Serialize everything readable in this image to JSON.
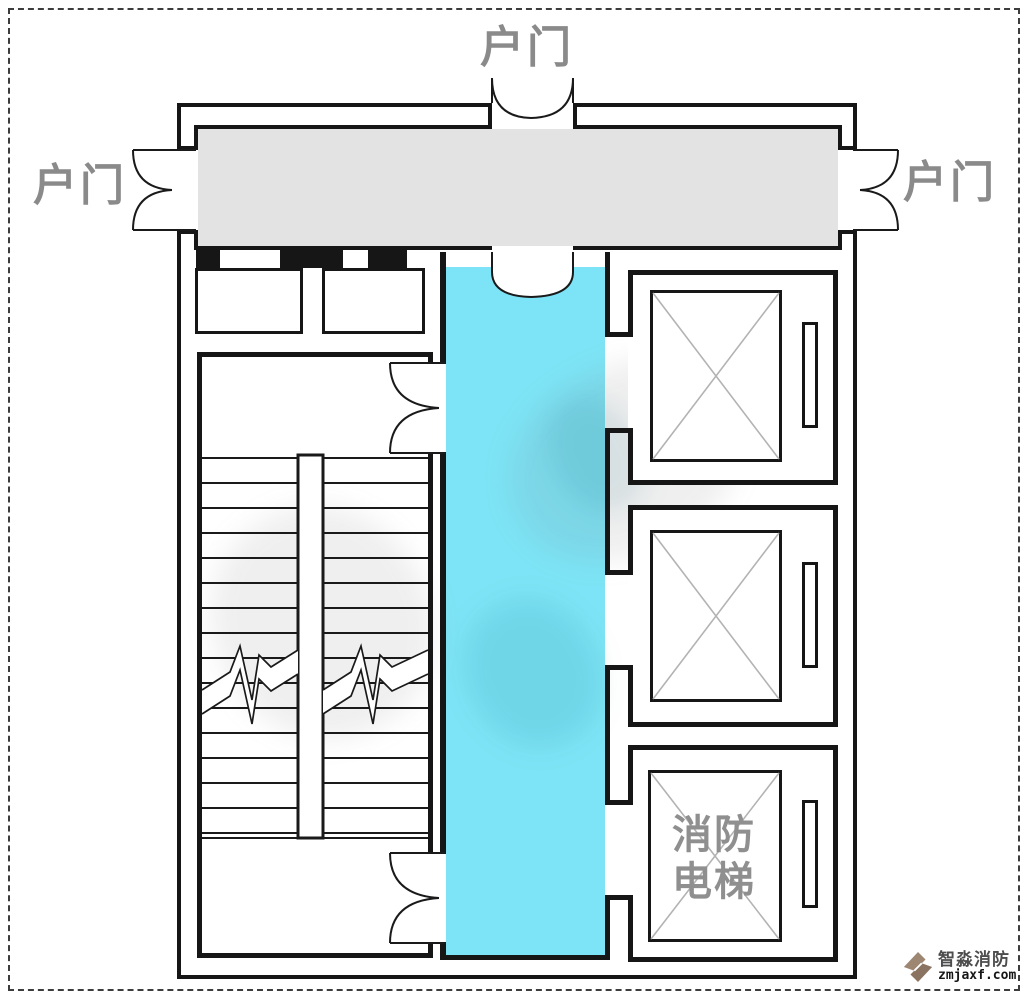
{
  "diagram": {
    "type": "floor-plan",
    "subject": "smokeproof elevator lobby with fire elevator and scissor stair"
  },
  "labels": {
    "top_door": "户门",
    "left_door": "户门",
    "right_door": "户门",
    "fire_elevator": "消防电梯"
  },
  "logo": {
    "name": "智淼消防",
    "domain": "zmjaxf.com",
    "icon": "zm-diamond-logo-icon"
  },
  "icons": {
    "door": "double-swing-door-icon",
    "elevator_cross": "elevator-shaft-cross-icon"
  },
  "colors": {
    "vestibule_fill": "#7ce4f6",
    "corridor_fill": "#e3e3e3",
    "wall": "#161616",
    "door_label": "#8a8a8a",
    "fire_elevator_label": "#8f8f8f",
    "elevator_cross": "#b3b3b3",
    "logo_brown": "#9d8672",
    "page_border": "#3d3d3d"
  }
}
